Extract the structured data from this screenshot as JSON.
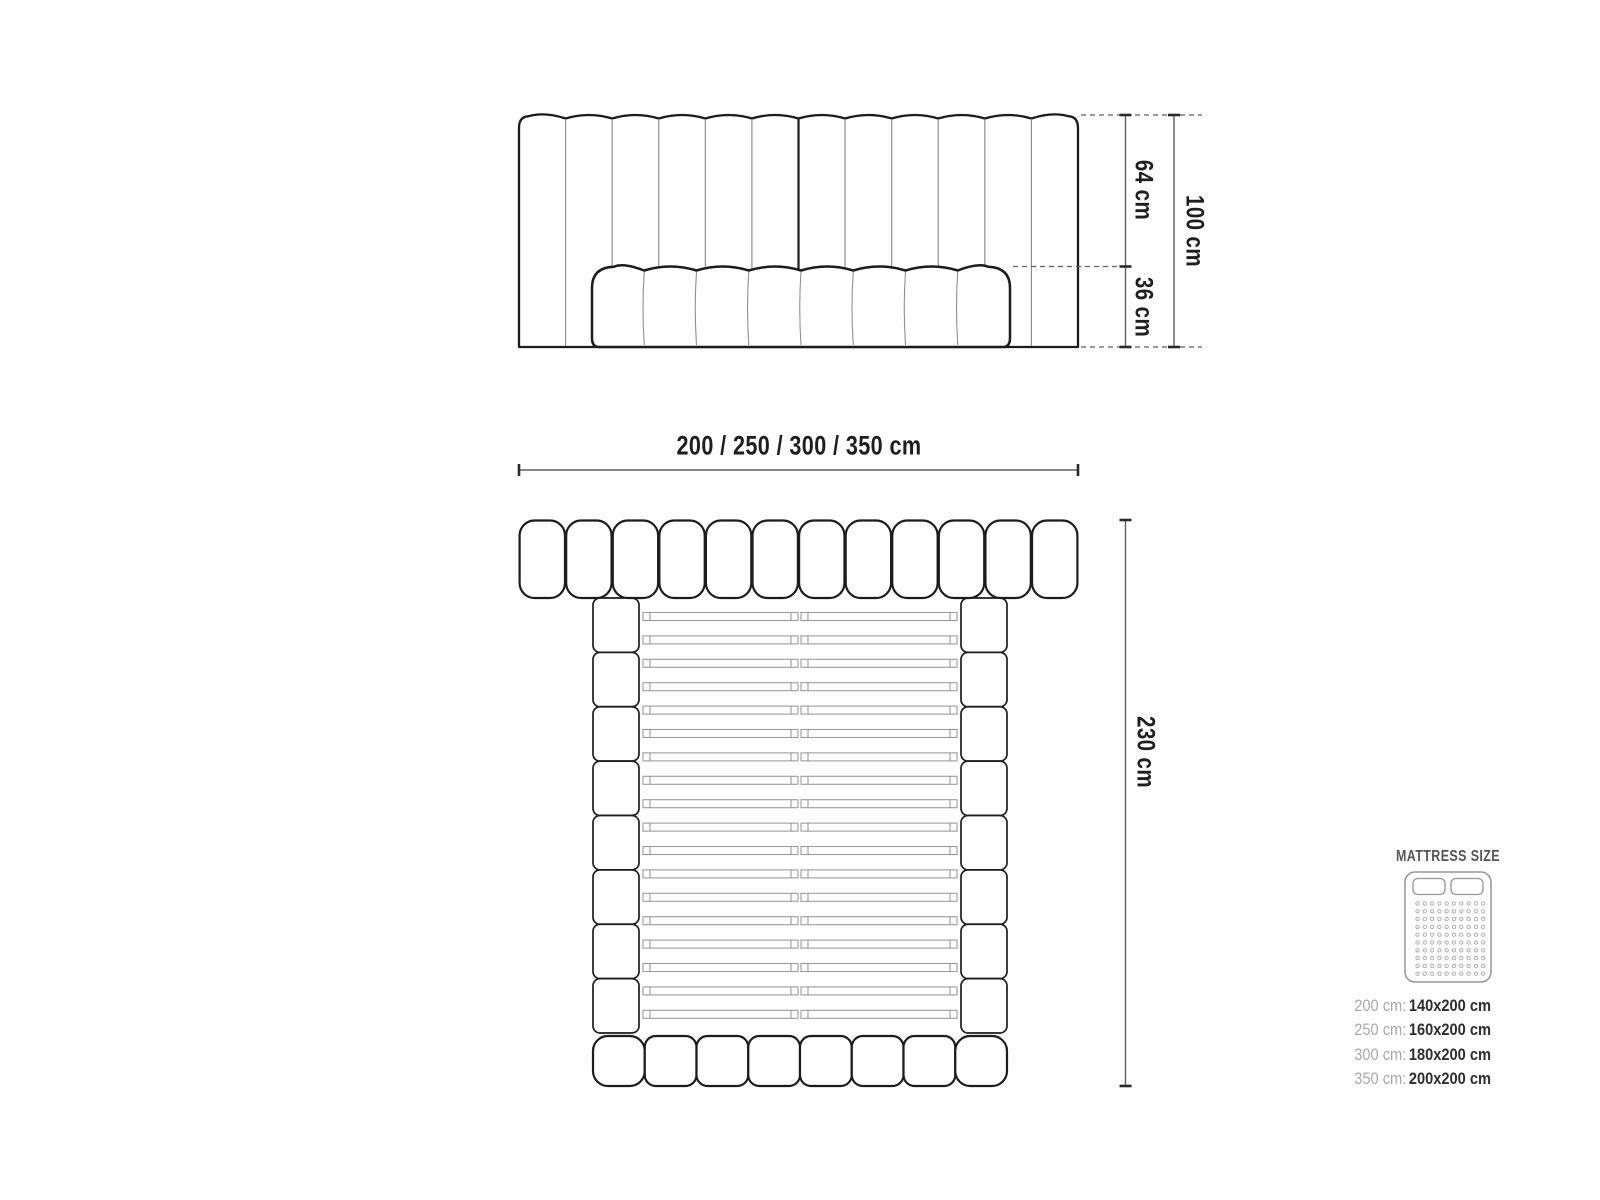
{
  "front_view": {
    "dim_upper": "64 cm",
    "dim_lower": "36 cm",
    "dim_total": "100 cm",
    "headboard_panels": 12,
    "base_segments": 8
  },
  "plan_view": {
    "dim_width": "200 / 250 / 300 / 350 cm",
    "dim_length": "230 cm",
    "headboard_segments": 12,
    "rail_segments_per_side": 8,
    "slat_rows": 18,
    "footboard_segments": 8
  },
  "legend": {
    "title": "MATTRESS SIZE",
    "rows": [
      {
        "width": "200 cm:",
        "size": "140x200 cm"
      },
      {
        "width": "250 cm:",
        "size": "160x200 cm"
      },
      {
        "width": "300 cm:",
        "size": "180x200 cm"
      },
      {
        "width": "350 cm:",
        "size": "200x200 cm"
      }
    ]
  },
  "colors": {
    "outline": "#1c1c1c",
    "divider": "#8f8f8f",
    "slat": "#9b9b9b",
    "dimension": "#5f5f5f",
    "tick": "#2a2a2a",
    "icon_stroke": "#979797",
    "icon_dot": "#b2b2b2"
  }
}
